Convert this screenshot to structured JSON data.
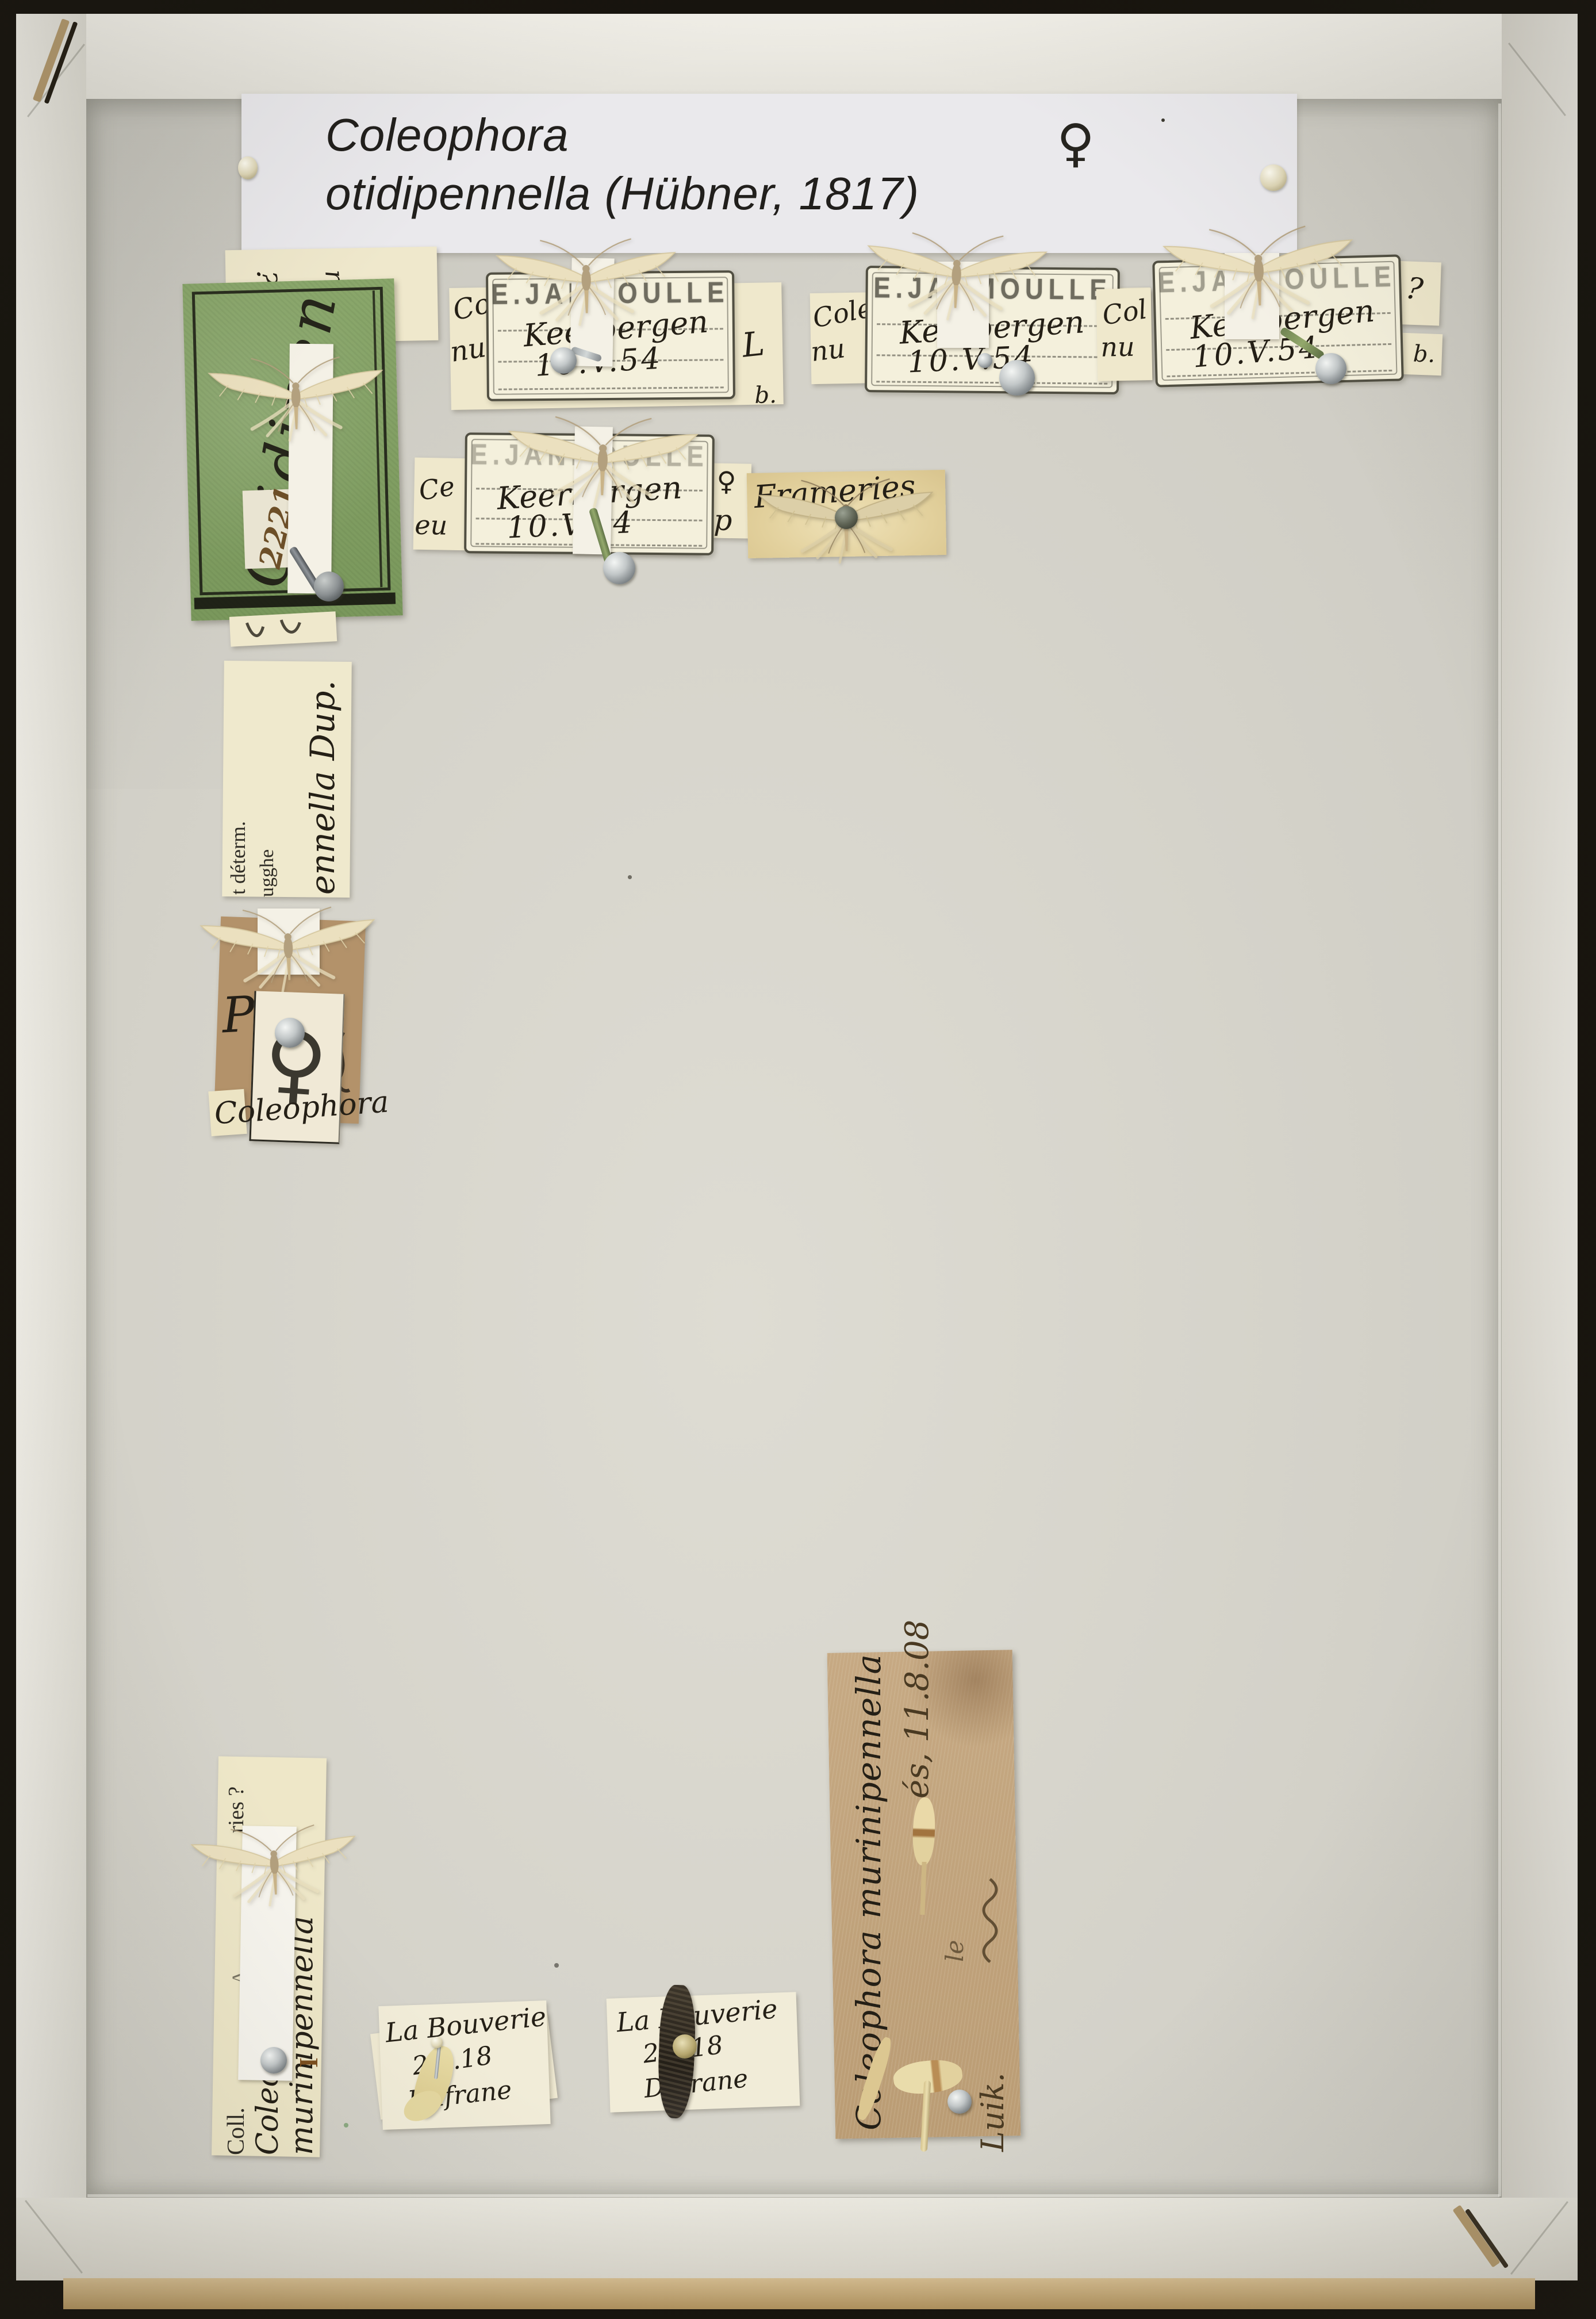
{
  "palette": {
    "background": "#17140e",
    "box_wall": "#e9e7df",
    "box_floor": "#d6d4cb",
    "label_cream": "#efe8cc",
    "stamp_paper": "#f4f0dc",
    "green_card": "#85a367",
    "brown_label": "#c0a37d",
    "ink_dark": "#26221b",
    "ink_brown": "#6d4f28",
    "pin_silver": "#b9bec0",
    "pin_verdigris": "#7d8f5e",
    "moth_wing": "#ebe0bf"
  },
  "header_label": {
    "genus": "Coleophora",
    "species": "otidipennella (Hübner, 1817)",
    "sex_symbol": "♀"
  },
  "specimens": [
    {
      "name": "keerbergen-1",
      "stamp": "E.JANMOULLE",
      "locality": "Keerbergen",
      "date": "10.V.54",
      "frag_left_top": "Col",
      "frag_left_bottom": "nu",
      "frag_right_top": "L",
      "frag_right_bottom": "b."
    },
    {
      "name": "keerbergen-2",
      "stamp": "E.JANMOULLE",
      "locality": "Keerbergen",
      "date": "10.V.54",
      "frag_left_top": "Cole",
      "frag_left_bottom": "nu"
    },
    {
      "name": "keerbergen-3",
      "stamp": "E.JANMOULLE",
      "locality": "Keerbergen",
      "date": "10.V.54",
      "frag_left_top": "Col",
      "frag_left_bottom": "nu",
      "frag_right_top": "?",
      "frag_right_bottom": "b."
    },
    {
      "name": "keerbergen-4",
      "stamp": "E.JANMOULLE",
      "locality": "Keerbergen",
      "date": "10.V.54",
      "frag_left_top": "Ce",
      "frag_left_bottom": "eu",
      "frag_right_top": "♀",
      "frag_right_bottom": "p"
    },
    {
      "name": "frameries",
      "locality": "Frameries"
    }
  ],
  "green_card": {
    "script": "Otidipen",
    "number": "2221",
    "mark_1": "?",
    "mark_2": "r"
  },
  "determ_label": {
    "printed_line1": "t déterm.",
    "printed_line2": "ugghe",
    "handwritten": "ennella Dup."
  },
  "brown_card": {
    "mark": "P"
  },
  "female_label": {
    "symbol": "♀"
  },
  "coll_label": {
    "printed_top": "ries ?",
    "printed_mid": "A",
    "printed_bottom": "Coll.",
    "handwritten_line1": "Coleophora",
    "handwritten_line2": "murinipennella",
    "mark": "I"
  },
  "bouverie_labels": [
    {
      "locality": "La Bouverie",
      "date": "2.6.18",
      "collector": "Dufrane"
    },
    {
      "locality": "La Bouverie",
      "date": "2.6.18",
      "collector": "Dufrane"
    }
  ],
  "brown_label": {
    "line1": "Coleophora murinipennella",
    "line2": "és, 11.8.08",
    "line2b": "le",
    "line3": "Luik."
  }
}
